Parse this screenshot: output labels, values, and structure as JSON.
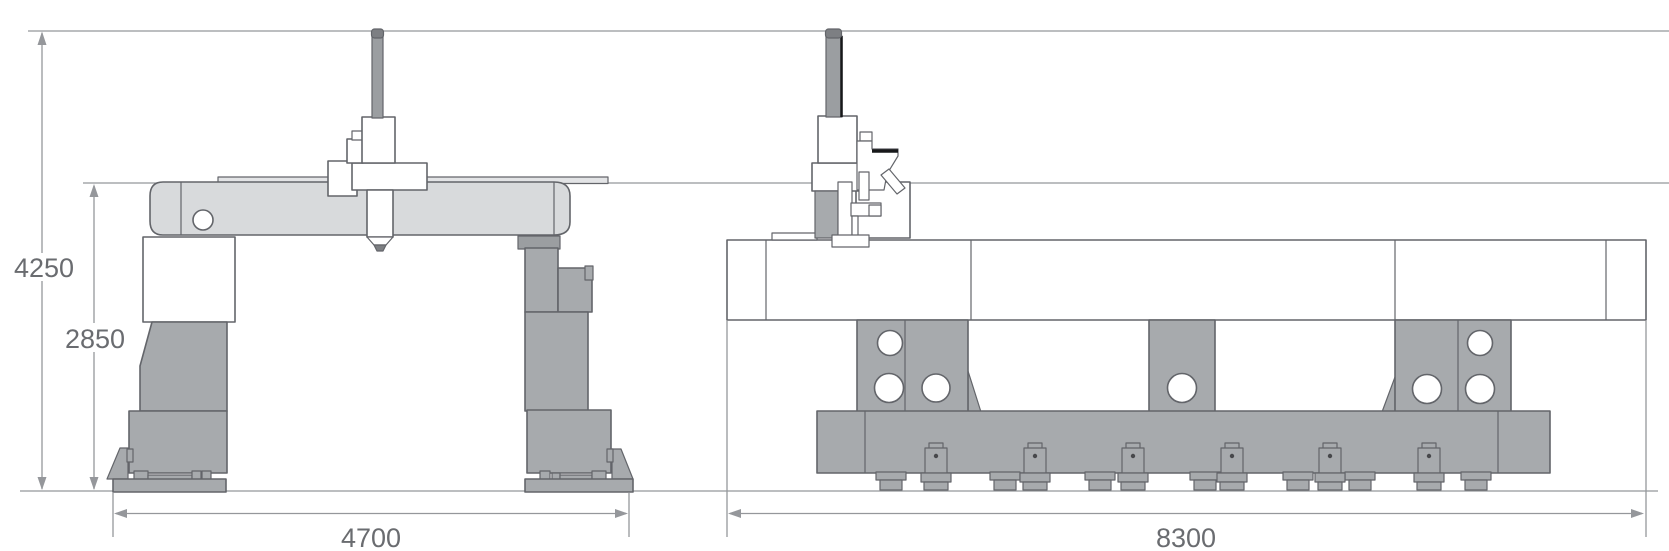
{
  "drawing": {
    "title": "Gantry machine dimensional drawing",
    "view_count": 2,
    "views": [
      {
        "id": "front-view",
        "description": "gantry front elevation with double columns and spindle ram"
      },
      {
        "id": "side-view",
        "description": "machine bed side elevation with pedestals, lightening holes and anchor feet"
      }
    ]
  },
  "dims": {
    "overall_height": "4250",
    "beam_height": "2850",
    "front_width": "4700",
    "side_length": "8300"
  },
  "dimensions_meta": [
    {
      "label": "4250",
      "orientation": "vertical",
      "view": "front-view",
      "meaning": "overall height to top of ram"
    },
    {
      "label": "2850",
      "orientation": "vertical",
      "view": "front-view",
      "meaning": "height to top of crossbeam"
    },
    {
      "label": "4700",
      "orientation": "horizontal",
      "view": "front-view",
      "meaning": "base width between foot plates"
    },
    {
      "label": "8300",
      "orientation": "horizontal",
      "view": "side-view",
      "meaning": "overall bed length"
    }
  ],
  "colors": {
    "beam_fill": "#d8dadc",
    "machine_gray": "#a7aaad",
    "machine_medium": "#9b9ea1",
    "outline": "#63656a",
    "dimension_line": "#95979b",
    "label_text": "#6a6c70",
    "background": "#ffffff"
  }
}
